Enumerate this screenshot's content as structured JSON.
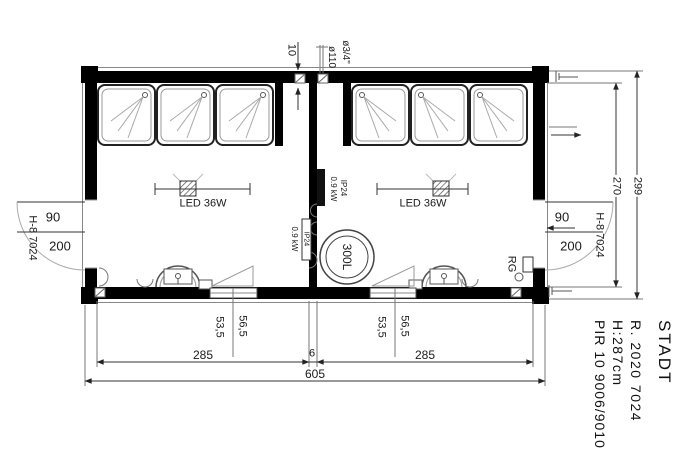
{
  "plan": {
    "top": {
      "wall_thickness": "10",
      "drain_pipe": "ø110",
      "water_pipe": "ø3/4\""
    },
    "left_room": {
      "led": "LED 36W",
      "heater_ip": "IP24",
      "heater_kw": "0.9 kW"
    },
    "right_room": {
      "led": "LED 36W",
      "heater_line1": "IP24",
      "heater_line2": "0.9 kW",
      "boiler": "300L",
      "rg": "RG"
    },
    "door_left": {
      "width": "90",
      "height": "200",
      "type": "H-8 7024"
    },
    "door_right": {
      "width": "90",
      "height": "200",
      "type": "H-8 7024"
    },
    "dims": {
      "interior_depth": "270",
      "exterior_depth": "299",
      "room_left_width": "285",
      "partition": "6",
      "room_right_width": "285",
      "total_width": "605",
      "win_left_a": "53,5",
      "win_left_b": "56,5",
      "win_right_a": "53,5",
      "win_right_b": "56,5"
    }
  },
  "title_block": {
    "project": "STADT",
    "ral": "R. 2020 7024",
    "height": "H:287cm",
    "material": "PIR 10 9006/9010"
  }
}
